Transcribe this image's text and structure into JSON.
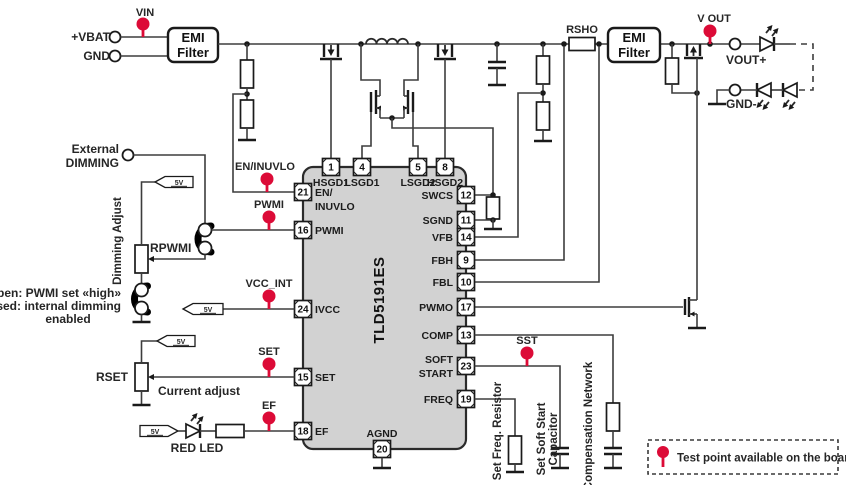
{
  "colors": {
    "test_point_red": "#dc0b37",
    "ic_fill": "#d2d2d2",
    "wire": "#3d3d3d"
  },
  "input": {
    "vbat": "+VBAT",
    "gnd": "GND"
  },
  "emi_filter": {
    "line1": "EMI",
    "line2": "Filter"
  },
  "test_points": {
    "vin": "VIN",
    "en_inuvlo": "EN/INUVLO",
    "pwmi": "PWMI",
    "vcc_int": "VCC_INT",
    "set": "SET",
    "ef": "EF",
    "sst": "SST",
    "v_out": "V OUT"
  },
  "dimming": {
    "external_line1": "External",
    "external_line2": "DIMMING",
    "adjust": "Dimming Adjust",
    "rpwmi": "RPWMI",
    "note1": "Open: PWMI set «high»",
    "note2": "Closed: internal dimming",
    "note3": "enabled"
  },
  "current": {
    "rset": "RSET",
    "adjust": "Current adjust"
  },
  "error_flag": {
    "red_led": "RED LED"
  },
  "net": {
    "v5": "5V"
  },
  "ic": {
    "part": "TLD5191ES",
    "pins": {
      "top": [
        {
          "num": "1",
          "label": "HSGD1"
        },
        {
          "num": "4",
          "label": "LSGD1"
        },
        {
          "num": "5",
          "label": "LSGD2"
        },
        {
          "num": "8",
          "label": "HSGD2"
        }
      ],
      "left": [
        {
          "num": "21",
          "label": "EN/",
          "label2": "INUVLO"
        },
        {
          "num": "16",
          "label": "PWMI"
        },
        {
          "num": "24",
          "label": "IVCC"
        },
        {
          "num": "15",
          "label": "SET"
        },
        {
          "num": "18",
          "label": "EF"
        }
      ],
      "right": [
        {
          "num": "12",
          "label": "SWCS"
        },
        {
          "num": "11",
          "label": "SGND"
        },
        {
          "num": "14",
          "label": "VFB"
        },
        {
          "num": "9",
          "label": "FBH"
        },
        {
          "num": "10",
          "label": "FBL"
        },
        {
          "num": "17",
          "label": "PWMO"
        },
        {
          "num": "13",
          "label": "COMP"
        },
        {
          "num": "23",
          "label": "SOFT",
          "label2": "START"
        },
        {
          "num": "19",
          "label": "FREQ"
        }
      ],
      "bottom": [
        {
          "num": "20",
          "label": "AGND"
        }
      ]
    }
  },
  "output": {
    "rsho": "RSHO",
    "vout_plus": "VOUT+",
    "gnd_minus": "GND-"
  },
  "bottom_networks": {
    "set_freq": "Set Freq. Resistor",
    "soft_start1": "Set Soft Start",
    "soft_start2": "Capacitor",
    "comp": "Compensation Network"
  },
  "legend": {
    "text": "Test point available on the board"
  }
}
